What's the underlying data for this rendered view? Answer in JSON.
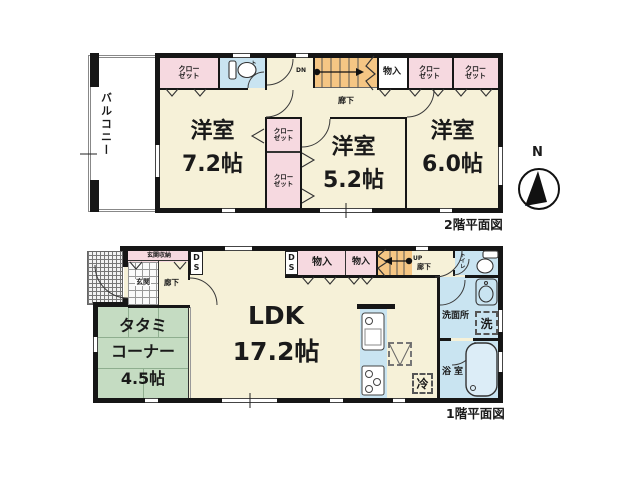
{
  "colors": {
    "room_cream": "#F6F1D8",
    "closet_pink": "#F6D9E0",
    "wet_blue": "#C9E4F1",
    "tatami_green": "#C5DCC2",
    "stairs_orange": "#F5C684",
    "wall_black": "#161616"
  },
  "floor2": {
    "title": "2階平面図",
    "compass_n": "N",
    "balcony": "バルコニー",
    "closet_l1": "クロー",
    "closet_l2": "ゼット",
    "toilet": "トイレ",
    "dn": "DN",
    "storage": "物入",
    "hallway": "廊下",
    "rooms": [
      {
        "name": "洋室",
        "size": "7.2帖"
      },
      {
        "name": "洋室",
        "size": "5.2帖"
      },
      {
        "name": "洋室",
        "size": "6.0帖"
      }
    ]
  },
  "floor1": {
    "title": "1階平面図",
    "entrance_storage": "玄関収納",
    "entrance": "玄関",
    "hallway_left": "廊下",
    "ds_l1": "D",
    "ds_l2": "S",
    "storage": "物入",
    "up": "UP",
    "hallway_right": "廊下",
    "toilet": "トイレ",
    "washroom": "洗面所",
    "washer": "洗",
    "bath": "浴室",
    "fridge": "冷",
    "tatami_l1": "タタミ",
    "tatami_l2": "コーナー",
    "tatami_l3": "4.5帖",
    "ldk_name": "LDK",
    "ldk_size": "17.2帖"
  }
}
